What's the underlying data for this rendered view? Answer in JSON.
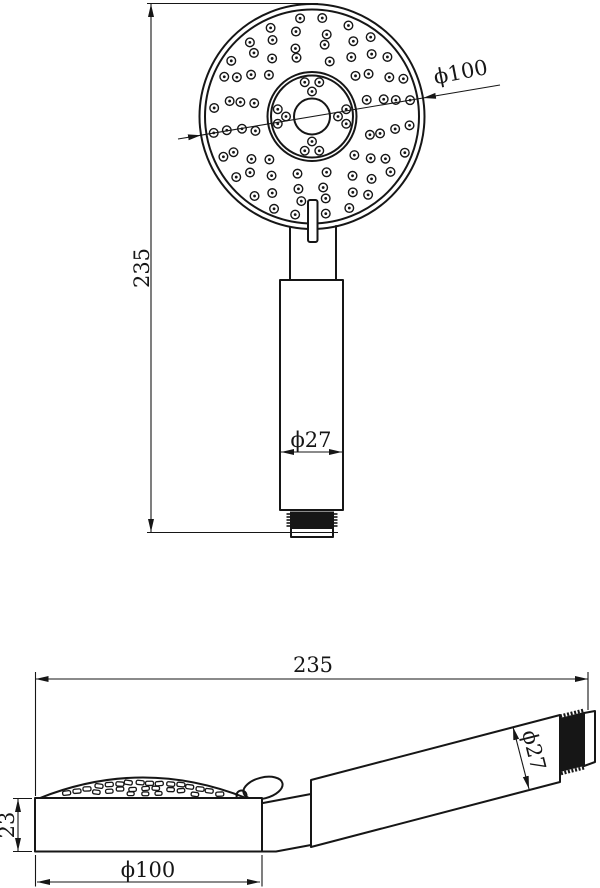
{
  "drawing": {
    "background_color": "#ffffff",
    "line_color": "#161616",
    "front_view": {
      "overall_height": "235",
      "head_diameter": "ϕ100",
      "handle_diameter": "ϕ27"
    },
    "side_view": {
      "overall_length": "235",
      "handle_diameter": "ϕ27",
      "head_thickness": "23",
      "head_diameter": "ϕ100"
    }
  }
}
